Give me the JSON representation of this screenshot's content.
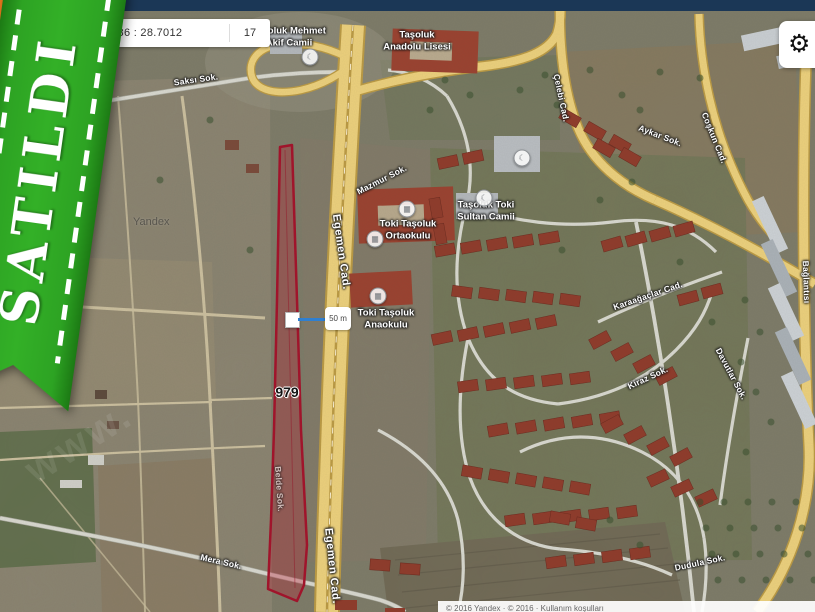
{
  "navbar": {
    "color": "#1b3756"
  },
  "ribbon": {
    "text": "SATILDI",
    "green": "#2da323",
    "orange": "#ee7a1d"
  },
  "coord_bar": {
    "coords": "2086 : 28.7012",
    "zoom_level": "17"
  },
  "settings": {
    "gear_glyph": "⚙"
  },
  "parcel": {
    "number": "979",
    "stroke": "#a3122a",
    "fill": "#c01830"
  },
  "scale_bar": {
    "label": "50 m",
    "line_color": "#2f7fd0"
  },
  "watermarks": {
    "yandex": "Yandex",
    "site": "www."
  },
  "copyright": "© 2016 Yandex · © 2016 · Kullanım koşulları",
  "map_labels": [
    {
      "t": "Saksı Sok.",
      "x": 196,
      "y": 80,
      "r": -8,
      "c": "road"
    },
    {
      "t": "Taşoluk Mehmet\nAkif Camii",
      "x": 289,
      "y": 38,
      "r": 0,
      "c": "poi"
    },
    {
      "t": "Taşoluk\nAnadolu Lisesi",
      "x": 417,
      "y": 42,
      "r": 0,
      "c": "poi"
    },
    {
      "t": "Mazmur Sok.",
      "x": 382,
      "y": 180,
      "r": -27,
      "c": "road"
    },
    {
      "t": "Toki Taşoluk\nOrtaokulu",
      "x": 408,
      "y": 231,
      "r": 0,
      "c": "poi"
    },
    {
      "t": "Taşoluk Toki\nSultan Camii",
      "x": 486,
      "y": 212,
      "r": 0,
      "c": "poi"
    },
    {
      "t": "Toki Taşoluk\nAnaokulu",
      "x": 386,
      "y": 320,
      "r": 0,
      "c": "poi"
    },
    {
      "t": "Egemen Cad.",
      "x": 341,
      "y": 252,
      "r": 82,
      "c": "road-lg"
    },
    {
      "t": "Egemen Cad.",
      "x": 332,
      "y": 566,
      "r": 84,
      "c": "road-lg"
    },
    {
      "t": "Çelebi Cad.",
      "x": 561,
      "y": 98,
      "r": 78,
      "c": "road"
    },
    {
      "t": "Aykar Sok.",
      "x": 660,
      "y": 136,
      "r": 21,
      "c": "road"
    },
    {
      "t": "Coşkun Cad.",
      "x": 714,
      "y": 138,
      "r": 68,
      "c": "road"
    },
    {
      "t": "Karaağaçlar Cad.",
      "x": 648,
      "y": 296,
      "r": -19,
      "c": "road"
    },
    {
      "t": "Davutlar Sok.",
      "x": 731,
      "y": 374,
      "r": 62,
      "c": "road"
    },
    {
      "t": "Kiraz Sok.",
      "x": 648,
      "y": 378,
      "r": -25,
      "c": "road"
    },
    {
      "t": "Mera Sok.",
      "x": 221,
      "y": 562,
      "r": 13,
      "c": "road"
    },
    {
      "t": "Belde Sok.",
      "x": 279,
      "y": 489,
      "r": 86,
      "c": "road faint"
    },
    {
      "t": "Bağlantısı",
      "x": 806,
      "y": 282,
      "r": 88,
      "c": "road"
    },
    {
      "t": "Dudula Sok.",
      "x": 700,
      "y": 563,
      "r": -12,
      "c": "road"
    }
  ],
  "poi_icons": [
    {
      "n": "school-icon",
      "g": "▦",
      "x": 407,
      "y": 209
    },
    {
      "n": "school-icon",
      "g": "▦",
      "x": 375,
      "y": 239
    },
    {
      "n": "mosque-icon",
      "g": "☾",
      "x": 484,
      "y": 198
    },
    {
      "n": "school-icon",
      "g": "▦",
      "x": 378,
      "y": 296
    },
    {
      "n": "mosque-icon",
      "g": "☾",
      "x": 522,
      "y": 158
    },
    {
      "n": "mosque-icon",
      "g": "☾",
      "x": 310,
      "y": 57
    }
  ]
}
